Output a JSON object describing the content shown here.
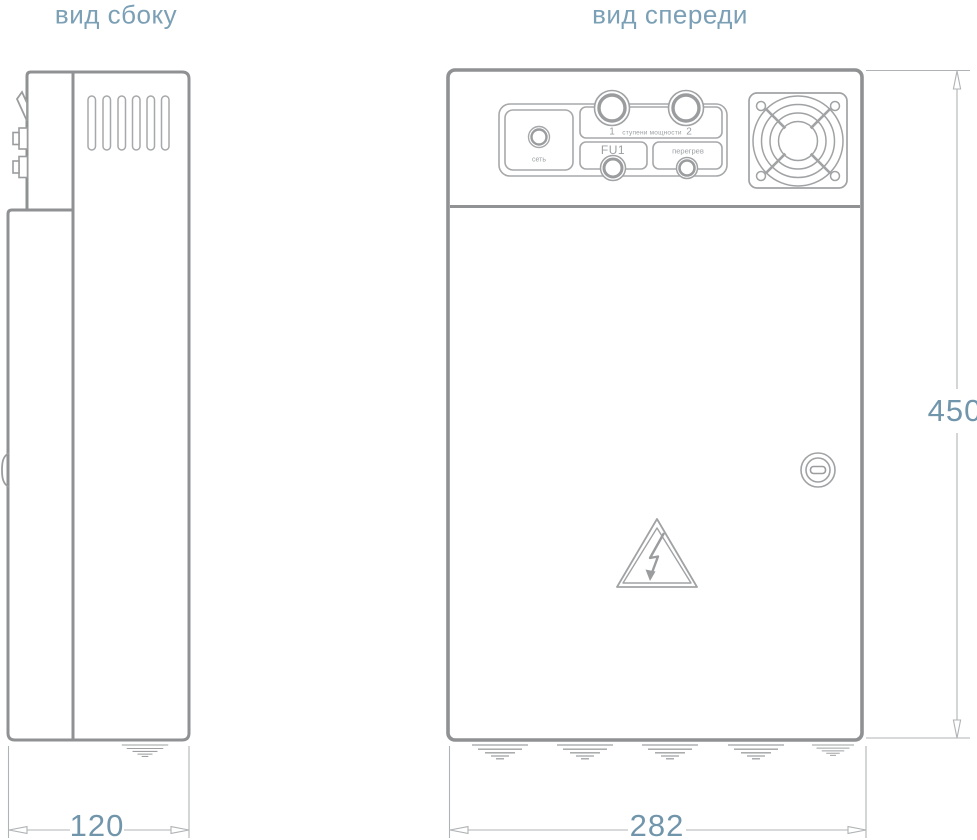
{
  "titles": {
    "side_view": "вид сбоку",
    "front_view": "вид спереди"
  },
  "dimensions": {
    "side_depth": "120",
    "front_width": "282",
    "height": "450"
  },
  "panel": {
    "power_label": "сеть",
    "stage_1": "1",
    "stage_2": "2",
    "stages_label": "ступени мощности",
    "fuse_label": "FU1",
    "overheat_label": "перегрев"
  },
  "colors": {
    "outline_gray": "#8f9193",
    "thin_gray": "#a6a8aa",
    "dimension_gray": "#b0b3b5",
    "text_blue": "#7398ae",
    "label_gray": "#9ca0a3"
  }
}
